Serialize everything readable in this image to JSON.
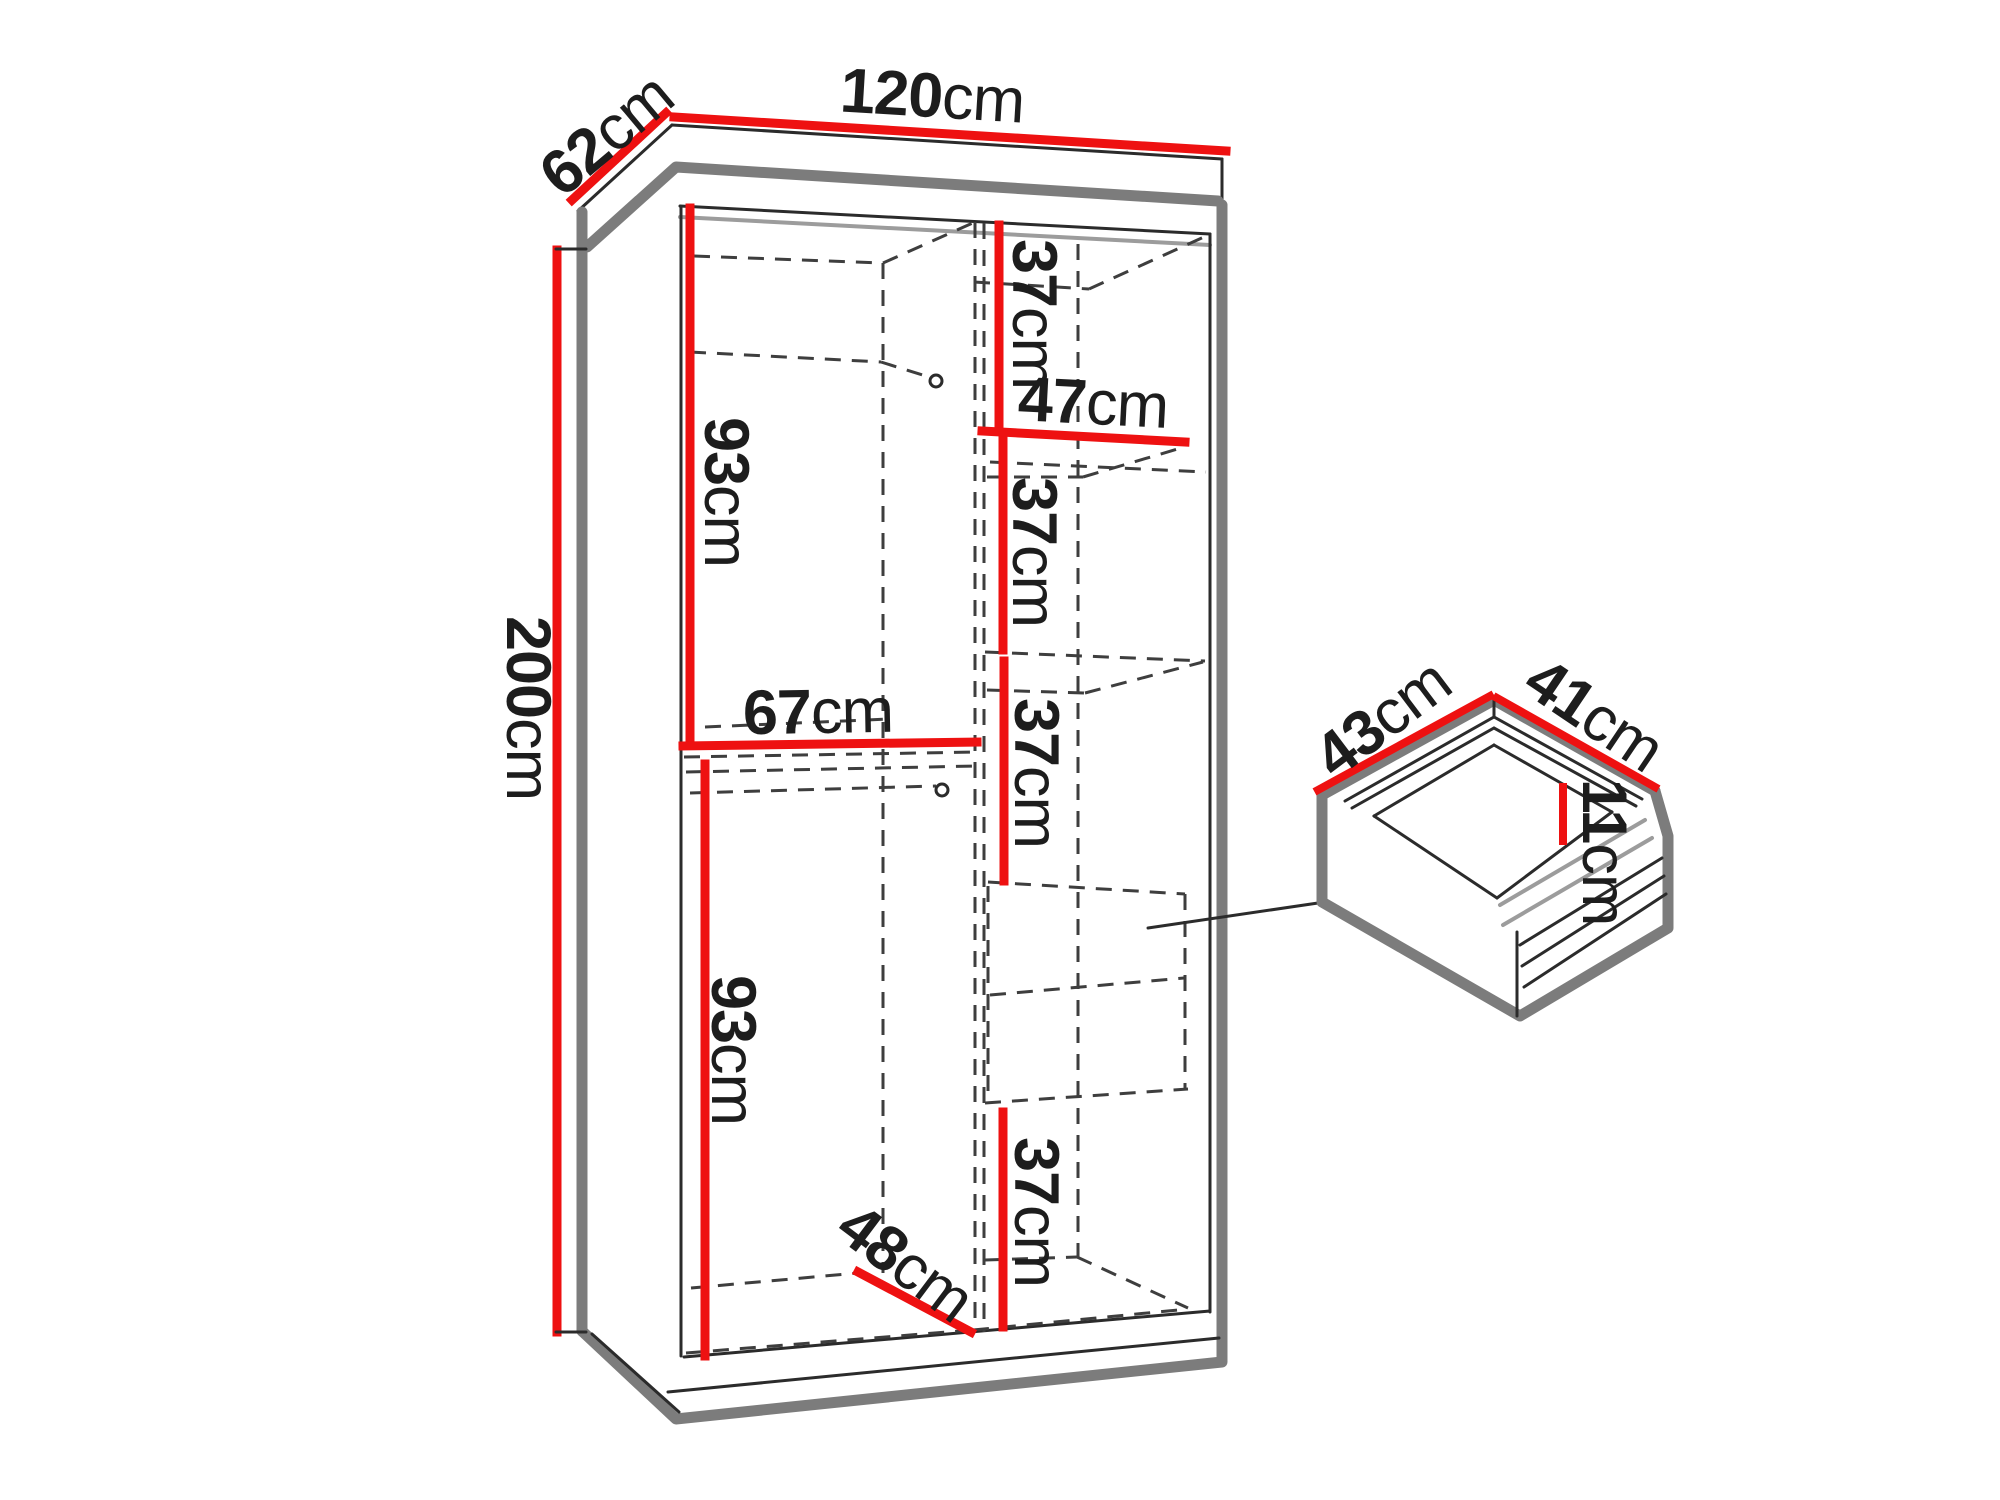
{
  "diagram": {
    "type": "furniture-dimension-diagram",
    "unit": "cm",
    "colors": {
      "dimension_line": "#ee1111",
      "outline_gray": "#7c7c7c",
      "line_dark": "#2b2b2b",
      "dashed_line": "#3e3e3e",
      "background": "#ffffff"
    },
    "wardrobe": {
      "width": {
        "value": "120",
        "unit": "cm"
      },
      "depth": {
        "value": "62",
        "unit": "cm"
      },
      "height": {
        "value": "200",
        "unit": "cm"
      },
      "left_upper_height": {
        "value": "93",
        "unit": "cm"
      },
      "left_shelf_width": {
        "value": "67",
        "unit": "cm"
      },
      "left_lower_height": {
        "value": "93",
        "unit": "cm"
      },
      "left_lower_depth": {
        "value": "48",
        "unit": "cm"
      },
      "right_shelf_width": {
        "value": "47",
        "unit": "cm"
      },
      "right_sections": [
        {
          "value": "37",
          "unit": "cm"
        },
        {
          "value": "37",
          "unit": "cm"
        },
        {
          "value": "37",
          "unit": "cm"
        },
        {
          "value": "37",
          "unit": "cm"
        }
      ]
    },
    "drawer": {
      "depth": {
        "value": "43",
        "unit": "cm"
      },
      "width": {
        "value": "41",
        "unit": "cm"
      },
      "height": {
        "value": "11",
        "unit": "cm"
      }
    }
  }
}
